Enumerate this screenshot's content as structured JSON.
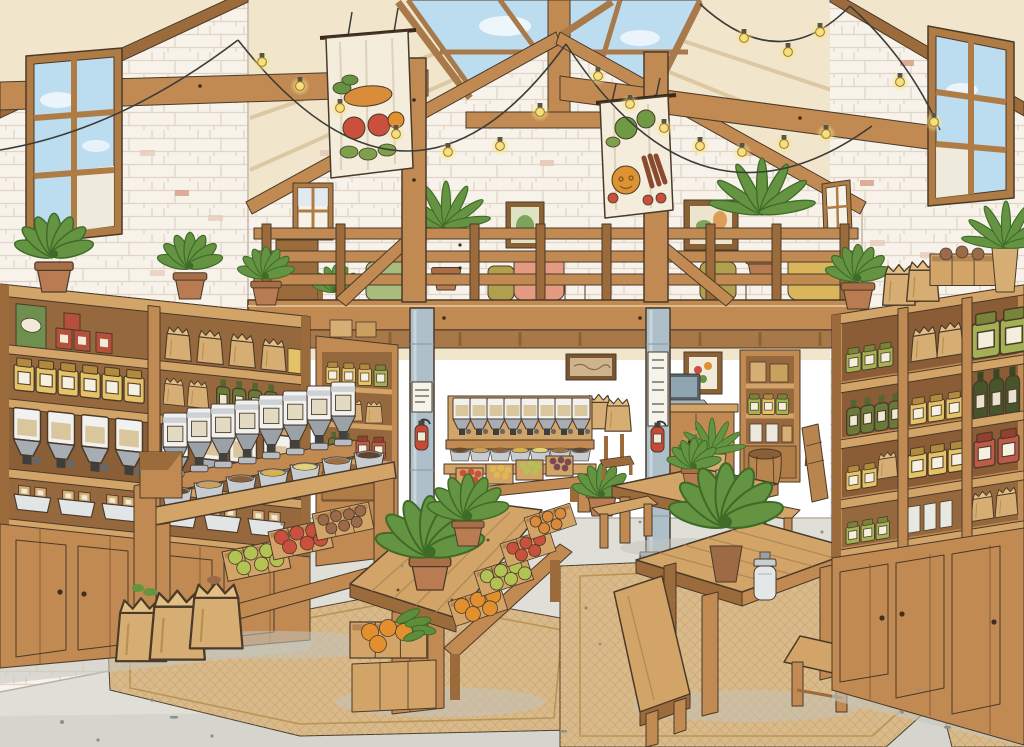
{
  "image": {
    "title": "Zero-waste bulk grocery store interior — watercolor illustration",
    "aria_label": "Hand-drawn watercolor illustration of a bright zero-waste bulk grocery store with a gabled timber roof, skylights, string lights, vegetable banners, a mezzanine lounge, wooden shelving full of jars and dispensers, produce tables and benches on jute rugs."
  },
  "scene": {
    "setting": "zero-waste bulk grocery store interior",
    "style": "hand-drawn ink and watercolor illustration",
    "roof": [
      "exposed timber king-post trusses",
      "ridge skylights showing blue sky and clouds",
      "cream plank ceiling"
    ],
    "lighting": [
      "warm string lights draped between the trusses"
    ],
    "banners": [
      {
        "fabric": "cream cloth",
        "motifs": [
          "carrot",
          "tomatoes",
          "radish",
          "leafy greens"
        ]
      },
      {
        "fabric": "cream cloth",
        "motifs": [
          "broccoli",
          "pumpkin",
          "carrot bunch",
          "radishes",
          "greens"
        ]
      }
    ],
    "mezzanine": [
      "timber slat railing",
      "sofas and armchairs",
      "cafe table and chairs",
      "potted palms",
      "framed pictures",
      "small bookshelf"
    ],
    "columns": {
      "count": 2,
      "material": "steel",
      "attachments": [
        "fire extinguisher",
        "notice sign"
      ]
    },
    "left_shelving": [
      "boxed goods and red tins",
      "amber preserve jars",
      "gravity bulk dispensers",
      "paper refill bags in trays",
      "cabinet base",
      "potted plants on top"
    ],
    "right_shelving": [
      "green preserve jars",
      "olive oil bottles",
      "mustard jars",
      "tomato jars",
      "paper sacks",
      "cabinet base",
      "plants, crate and paper bags on top"
    ],
    "bulk_island": [
      "row of eight bulk dispensers",
      "open scoop bins of grains",
      "tilted crates of green apples, tomatoes and onions",
      "kraft paper bags on the rug"
    ],
    "back_area": [
      "counter with laptop",
      "tall hutch of packaged goods",
      "wooden barrel",
      "framed prints",
      "small bulk dispenser stand",
      "bench of produce crates",
      "wooden chair",
      "leaning board"
    ],
    "produce_table": [
      "two potted plants",
      "tilted crates of oranges, green apples, tomatoes and persimmons",
      "floor crate of oranges and greens"
    ],
    "cafe_tables": [
      "two plank tables with benches",
      "potted plant",
      "glass milk jug",
      "cup",
      "wooden stool"
    ],
    "floor": [
      "polished concrete with speckles",
      "two woven jute rugs",
      "corner rug"
    ],
    "windows": [
      "large paned window on the left wall",
      "large paned window on the right wall",
      "small window on the back wall",
      "small window on the right wall"
    ]
  },
  "palette": {
    "ink": "#4a3a2a",
    "wall": "#f7f2ea",
    "wallShade": "#efe7db",
    "brickPink": "#e8cdbc",
    "brickRed": "#d99c84",
    "ceiling": "#f1e5cc",
    "wood": "#c08a52",
    "woodLight": "#d3a468",
    "woodDark": "#9c6b3c",
    "woodDeep": "#7c5228",
    "sky": "#bcdcf0",
    "cloud": "#f2f8fc",
    "floor": "#dfdfd8",
    "floorFront": "#d4d4cc",
    "rug": "#d9ba8a",
    "rugLine": "#bd9a64",
    "steel": "#aebfc9",
    "red": "#c64a36",
    "banner": "#f4eddc",
    "bulb": "#f6df7d",
    "plant": "#649441",
    "plantDark": "#3f6b28",
    "pot": "#b97c52",
    "bag": "#d6ad72",
    "jarYellow": "#e5c268",
    "bottleGreen": "#6b7a3a",
    "oilGreen": "#47552a",
    "dispenser": "#f1f2ef",
    "metal": "#b7bcc2",
    "produceGreen": "#b2c353",
    "produceRed": "#c8503c",
    "produceOrange": "#e2902f",
    "produceBrown": "#9a6b4a",
    "sofaSalmon": "#e59a82",
    "sofaOlive": "#b0a04e",
    "sofaSage": "#a8bc7e",
    "sofaMustard": "#d9b65c"
  }
}
